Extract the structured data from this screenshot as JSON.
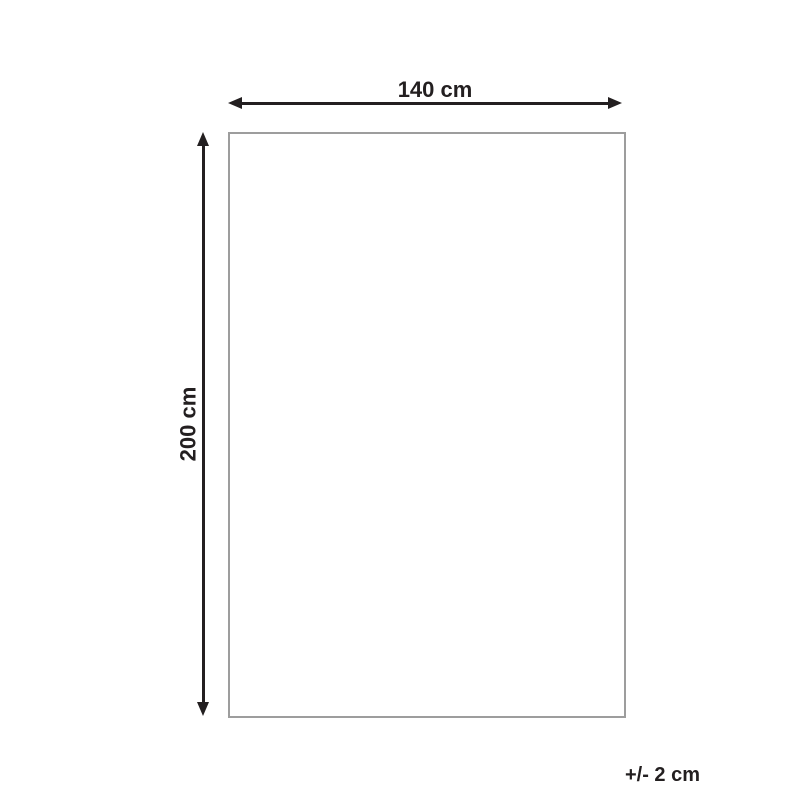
{
  "diagram": {
    "type": "product-dimension-diagram",
    "dimensions": {
      "width": {
        "label": "140 cm"
      },
      "height": {
        "label": "200 cm"
      },
      "tolerance": {
        "label": "+/- 2 cm"
      }
    }
  },
  "colors": {
    "ink": "#231f20",
    "outline": "#9d9d9d",
    "background": "#ffffff"
  }
}
